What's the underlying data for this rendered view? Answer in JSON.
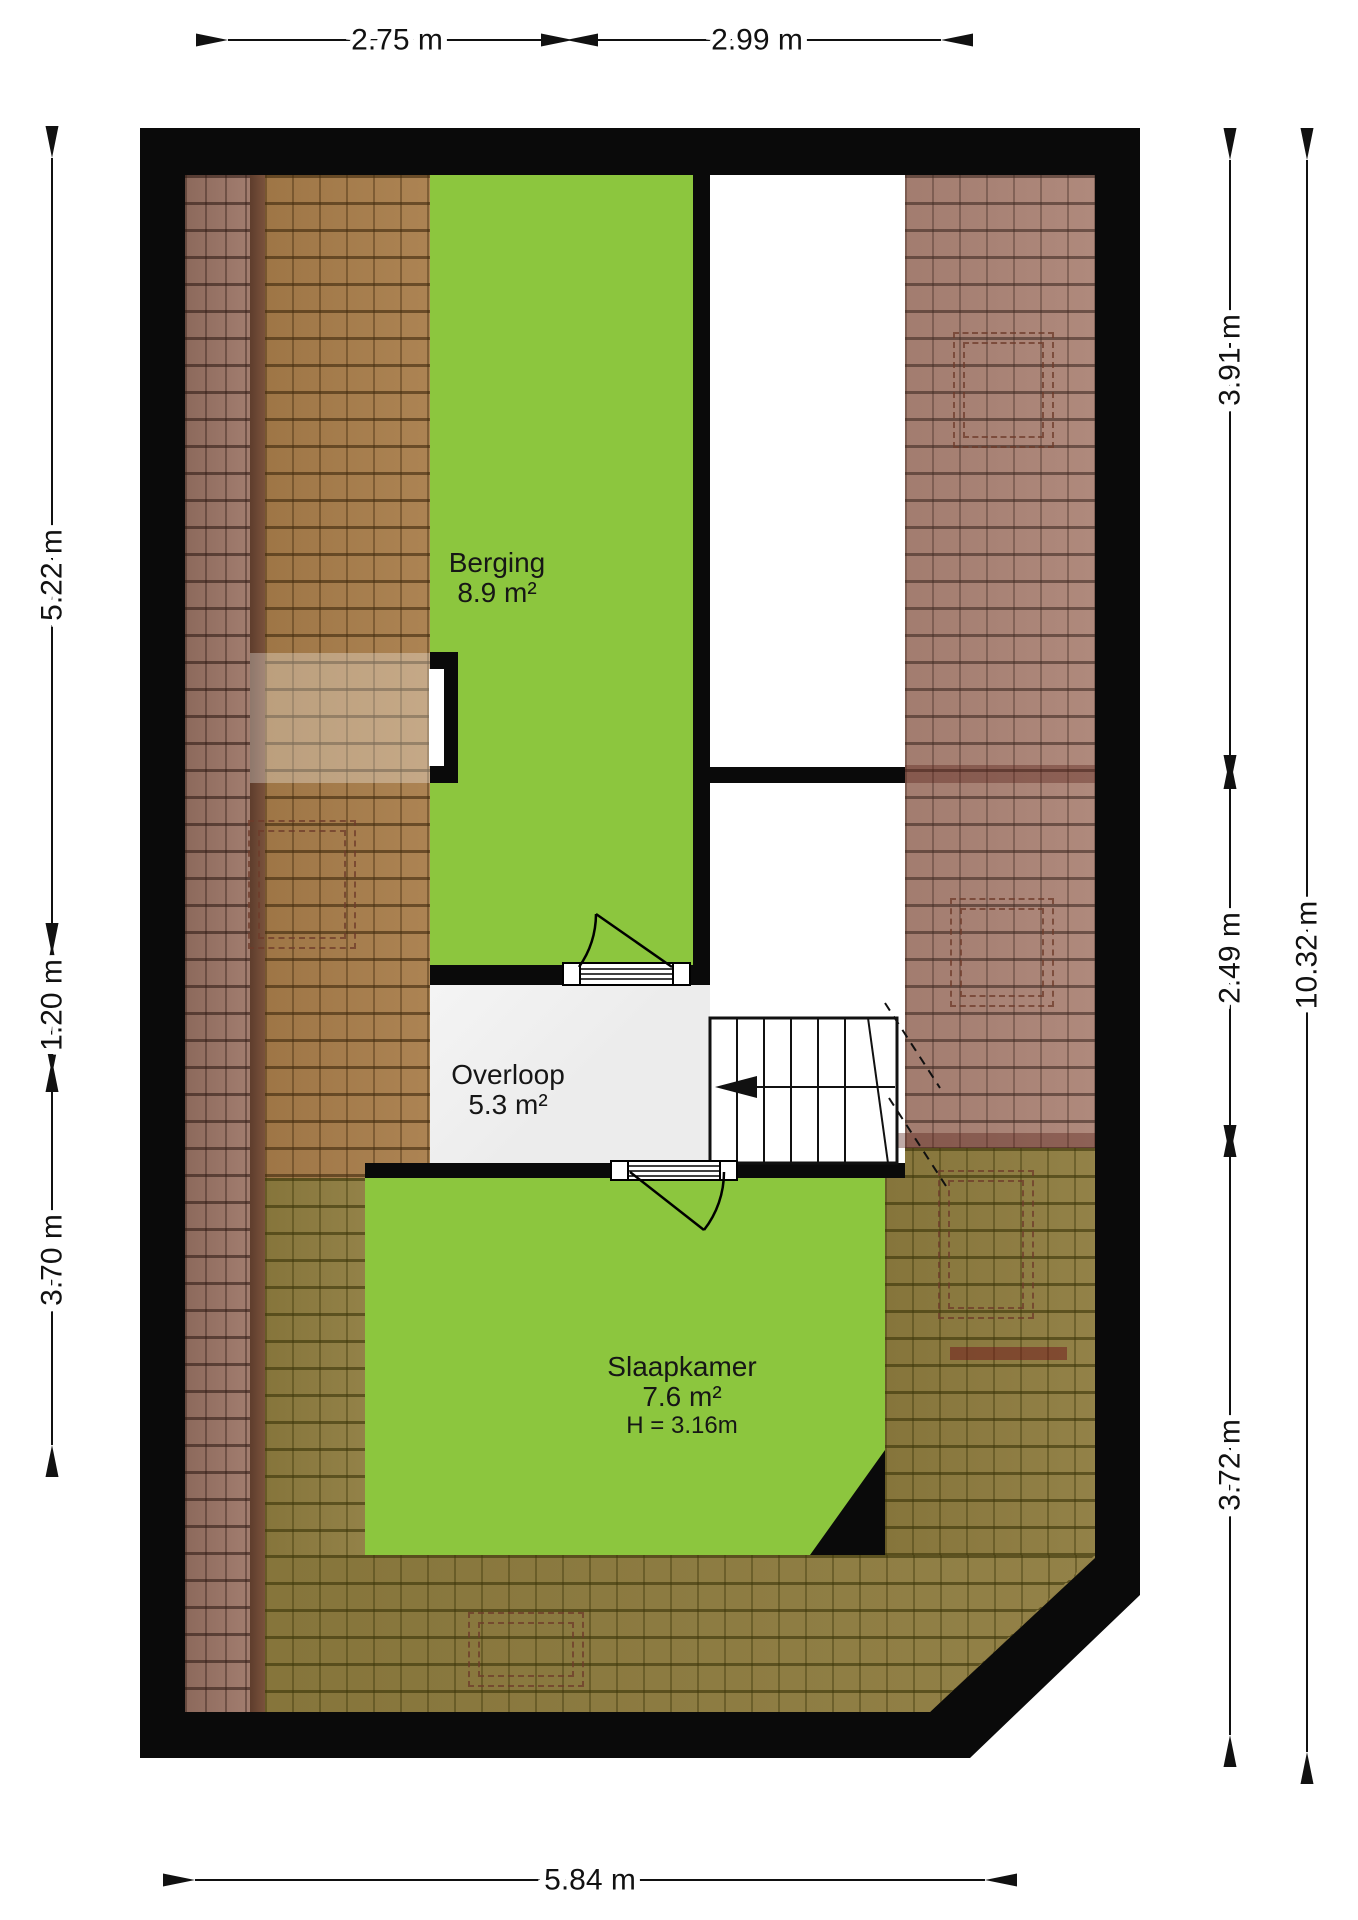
{
  "rooms": {
    "berging": {
      "name": "Berging",
      "area": "8.9 m²"
    },
    "overloop": {
      "name": "Overloop",
      "area": "5.3 m²"
    },
    "slaapkamer": {
      "name": "Slaapkamer",
      "area": "7.6 m²",
      "ceiling_height": "H = 3.16m"
    }
  },
  "dimensions": {
    "top": [
      "2.75 m",
      "2.99 m"
    ],
    "left": [
      "5.22 m",
      "1.20 m",
      "3.70 m"
    ],
    "right": [
      "3.91 m",
      "2.49 m",
      "3.72 m"
    ],
    "right_total": "10.32 m",
    "bottom": "5.84 m"
  },
  "colors": {
    "room-green": "#8cc63e",
    "hall-gray": "#ececec",
    "wall-black": "#0a0a0a",
    "roof-dark": "#9c7566",
    "roof-gold": "#a87d4a",
    "roof-pink": "#ab8375",
    "roof-olive": "#8d7b3e",
    "dashed-line": "#6e3b2a",
    "dim-text": "#111111"
  }
}
